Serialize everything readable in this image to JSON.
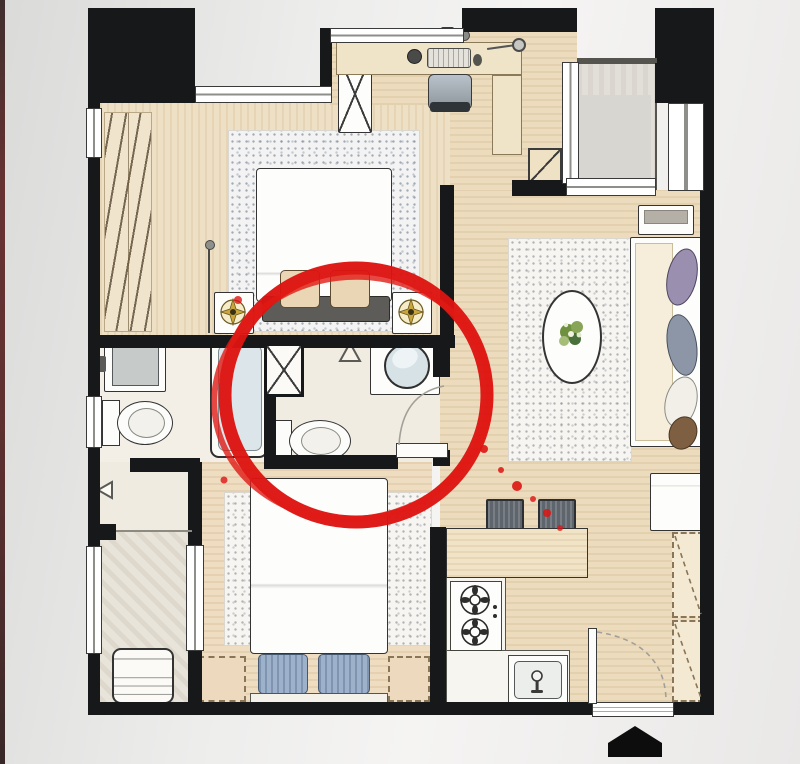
{
  "meta": {
    "type": "floor-plan-illustration",
    "style": "hand-drawn watercolor apartment plan",
    "annotation_note": "red marker circle highlights the central en-suite bathroom",
    "orientation_marker": "black entrance arrow at bottom"
  },
  "palette": {
    "background": "#ededec",
    "left_edge_strip": "#4a1010",
    "wall": "#17181a",
    "wood_floor": "#ecdcbd",
    "tile_floor": "#f2eee4",
    "rug": "#f6f5f1",
    "annotation_red": "#dd1411",
    "gold_light_symbol": "#c9a53c",
    "bathtub_inner": "#dce5e9",
    "basin_inner": "#d7e2e6",
    "pillow_blue": "#9db2ca",
    "sofa_cushion_purple": "#9a8fae",
    "sofa_cushion_gray_blue": "#8d96a6",
    "sofa_cushion_brown": "#7e5f41",
    "bench_dark": "#5d5c58",
    "stool_gray": "#5e656d"
  },
  "annotation": {
    "shape": "hand-drawn-circle",
    "color": "#dd1411",
    "center_x": 356,
    "center_y": 395,
    "radius_x": 131,
    "radius_y": 127,
    "highlights": "en-suite bathroom (washbasin, toilet, service shaft, door)"
  },
  "rooms": [
    {
      "name": "master-bedroom",
      "furniture": [
        "hanging-wardrobe-rail",
        "double-bed",
        "foot-bench-with-two-cushions",
        "nightstand-left",
        "nightstand-right",
        "ceiling-light-symbol-left",
        "ceiling-light-symbol-right",
        "floor-lamp",
        "area-rug"
      ]
    },
    {
      "name": "workspace-nook",
      "furniture": [
        "desk",
        "desk-chair",
        "keyboard",
        "speaker",
        "desk-lamp",
        "wall-shelf",
        "mouse",
        "storage-cabinet"
      ]
    },
    {
      "name": "balcony",
      "furniture": [
        "balcony-door",
        "glazing"
      ]
    },
    {
      "name": "living-room",
      "furniture": [
        "area-rug",
        "oval-coffee-table-with-plant",
        "sofa-with-four-cushions",
        "console-table",
        "side-cabinet"
      ]
    },
    {
      "name": "ensuite-bathroom-highlighted",
      "furniture": [
        "round-washbasin-on-counter",
        "toilet",
        "service-shaft",
        "door-leaf",
        "door-triangle-mark"
      ]
    },
    {
      "name": "main-bathroom",
      "furniture": [
        "washbasin",
        "toilet",
        "bathtub"
      ]
    },
    {
      "name": "hallway",
      "furniture": [
        "door-triangle-mark"
      ]
    },
    {
      "name": "service-balcony",
      "furniture": [
        "washing-machine",
        "sliding-window"
      ]
    },
    {
      "name": "bedroom-2",
      "furniture": [
        "double-bed",
        "two-pillows",
        "headboard",
        "area-rug",
        "bedside-cabinet-left",
        "bedside-cabinet-right"
      ]
    },
    {
      "name": "kitchen",
      "furniture": [
        "counter",
        "two-burner-gas-stove",
        "sink",
        "bar-stool-1",
        "bar-stool-2"
      ]
    },
    {
      "name": "entry",
      "furniture": [
        "entrance-door-leaf",
        "entrance-opening",
        "shoe-cabinet-upper",
        "shoe-cabinet-lower",
        "entrance-arrow"
      ]
    }
  ]
}
